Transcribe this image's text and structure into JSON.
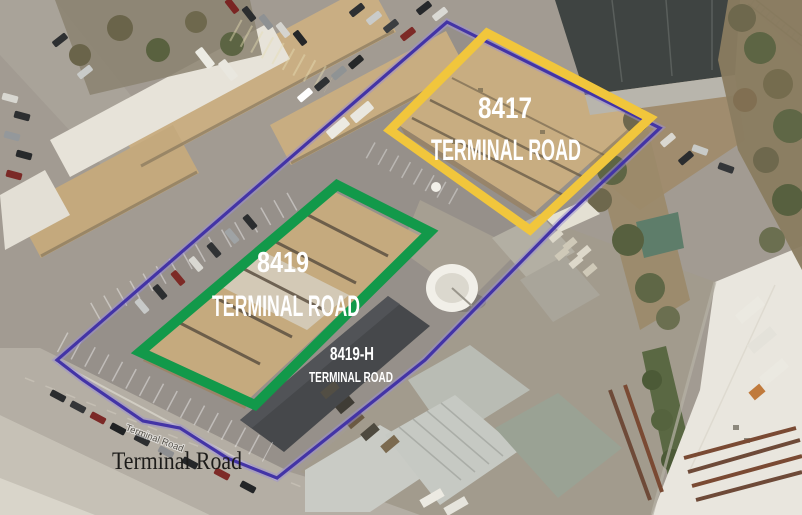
{
  "labels": {
    "parcel_8417": {
      "line1": "8417",
      "line2": "TERMINAL ROAD"
    },
    "parcel_8419": {
      "line1": "8419",
      "line2": "TERMINAL ROAD"
    },
    "parcel_8419_h": {
      "line1": "8419-H",
      "line2": "TERMINAL ROAD"
    },
    "street_large": "Terminal Road",
    "street_small": "Terminal Road"
  },
  "colors": {
    "outline_8417": "#F1C63C",
    "outline_8419": "#12994A",
    "property_line": "#4334A6",
    "property_line_glow": "#9A8ED6"
  }
}
